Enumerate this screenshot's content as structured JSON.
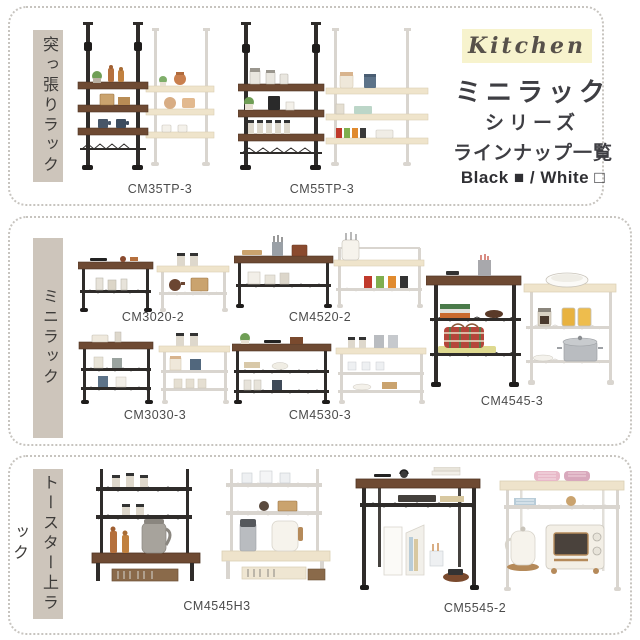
{
  "header": {
    "kitchen_label": "Kitchen",
    "title": "ミニラック",
    "subtitle_line1": "シリーズ",
    "subtitle_line2": "ラインナップ一覧",
    "color_legend": "Black ■ / White □"
  },
  "colors": {
    "highlight_yellow": "#f7f3cd",
    "section_label_bg": "#cdc5bb",
    "dotted_border": "#c7c4bf",
    "black_frame": "#2f2c2a",
    "dark_wood": "#6e4a33",
    "cream_shelf": "#eee3cb",
    "white_frame": "#d9d5cf",
    "text_dark": "#3e3e43"
  },
  "sections": [
    {
      "label": "突っ張りラック",
      "products": [
        {
          "model": "CM35TP-3"
        },
        {
          "model": "CM55TP-3"
        }
      ]
    },
    {
      "label": "ミニラック",
      "products": [
        {
          "model": "CM3020-2"
        },
        {
          "model": "CM4520-2"
        },
        {
          "model": "CM3030-3"
        },
        {
          "model": "CM4530-3"
        },
        {
          "model": "CM4545-3"
        }
      ]
    },
    {
      "label": "トースター上ラック",
      "products": [
        {
          "model": "CM4545H3"
        },
        {
          "model": "CM5545-2"
        }
      ]
    }
  ]
}
